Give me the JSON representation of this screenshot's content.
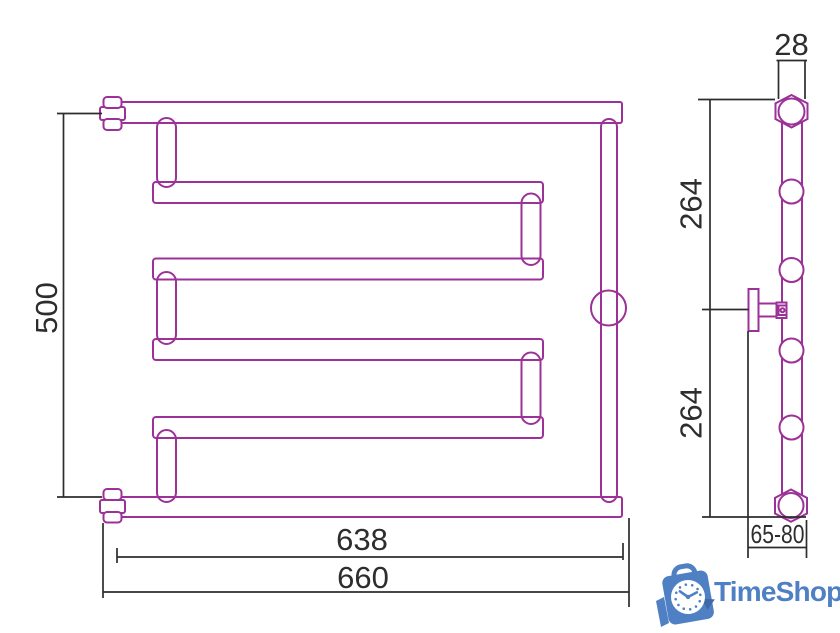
{
  "drawing": {
    "front_view": {
      "height": "500",
      "tube_length": "638",
      "overall_width": "660"
    },
    "side_view": {
      "pipe_diameter": "28",
      "upper_section": "264",
      "lower_section": "264",
      "wall_clearance": "65-80"
    }
  },
  "logo": {
    "brand": "TimeShop"
  },
  "colors": {
    "drawing_outline": "#9c3197",
    "dimension_lines": "#2d2d2d",
    "brand_blue": "#4f80c3"
  }
}
